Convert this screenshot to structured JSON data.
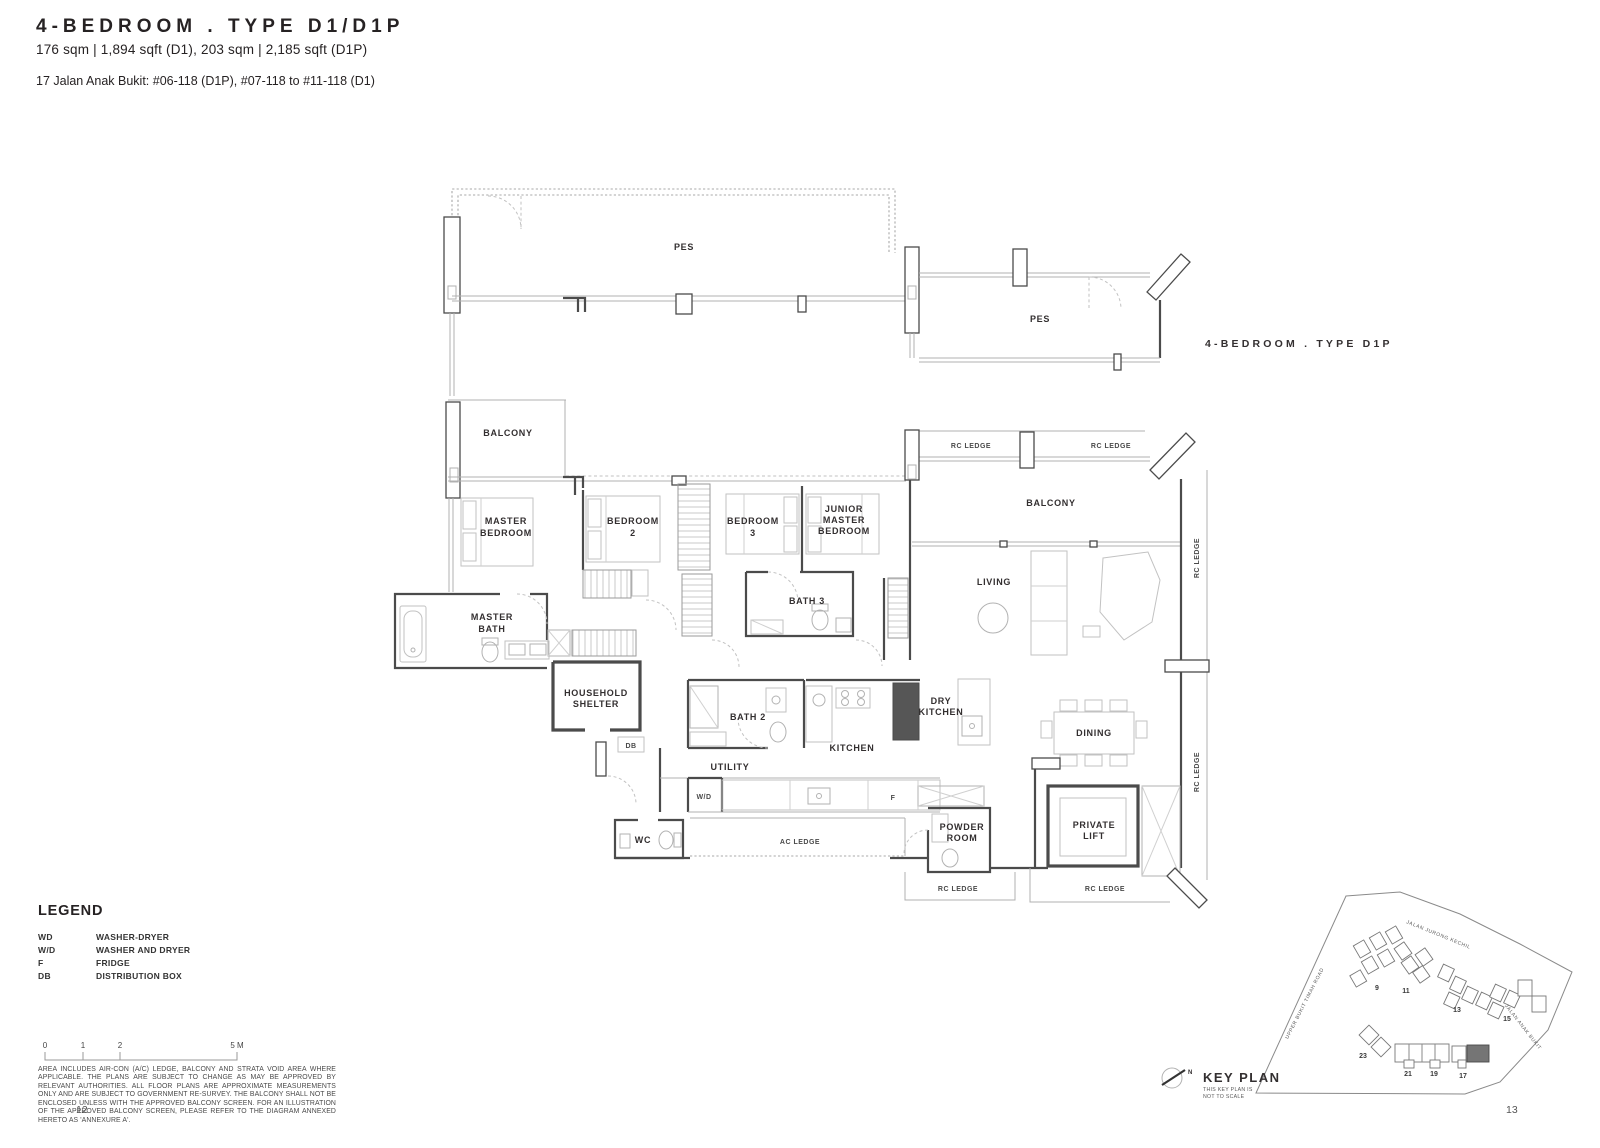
{
  "header": {
    "title": "4-BEDROOM . TYPE D1/D1P",
    "area_info": "176 sqm | 1,894 sqft (D1), 203 sqm | 2,185 sqft (D1P)",
    "address": "17 Jalan Anak Bukit: #06-118 (D1P), #07-118 to #11-118 (D1)"
  },
  "plan": {
    "variant_label": "4-BEDROOM . TYPE D1P",
    "rooms": {
      "pes1": "PES",
      "pes2": "PES",
      "balcony_left": "BALCONY",
      "balcony_right": "BALCONY",
      "master_bedroom": [
        "MASTER",
        "BEDROOM"
      ],
      "bedroom2": [
        "BEDROOM",
        "2"
      ],
      "bedroom3": [
        "BEDROOM",
        "3"
      ],
      "junior_master": [
        "JUNIOR",
        "MASTER",
        "BEDROOM"
      ],
      "master_bath": [
        "MASTER",
        "BATH"
      ],
      "bath3": "BATH 3",
      "bath2": "BATH 2",
      "household_shelter": [
        "HOUSEHOLD",
        "SHELTER"
      ],
      "kitchen": "KITCHEN",
      "dry_kitchen": [
        "DRY",
        "KITCHEN"
      ],
      "living": "LIVING",
      "dining": "DINING",
      "utility": "UTILITY",
      "wc": "WC",
      "powder_room": [
        "POWDER",
        "ROOM"
      ],
      "private_lift": [
        "PRIVATE",
        "LIFT"
      ]
    },
    "tags": {
      "db": "DB",
      "wd": "W/D",
      "f": "F",
      "ac_ledge": "AC LEDGE",
      "rc_ledge": "RC LEDGE"
    }
  },
  "legend": {
    "heading": "LEGEND",
    "rows": [
      {
        "abbr": "WD",
        "desc": "WASHER-DRYER"
      },
      {
        "abbr": "W/D",
        "desc": "WASHER AND DRYER"
      },
      {
        "abbr": "F",
        "desc": "FRIDGE"
      },
      {
        "abbr": "DB",
        "desc": "DISTRIBUTION BOX"
      }
    ]
  },
  "scale_bar": {
    "labels": [
      "0",
      "1",
      "2",
      "5 M"
    ]
  },
  "keyplan": {
    "title": "KEY PLAN",
    "note": [
      "THIS KEY PLAN IS",
      "NOT TO SCALE"
    ],
    "roads": [
      "JALAN JURONG KECHIL",
      "UPPER BUKIT TIMAH ROAD",
      "JALAN ANAK BUKIT"
    ],
    "blocks": [
      "9",
      "11",
      "13",
      "15",
      "23",
      "21",
      "19",
      "17"
    ],
    "compass": "N",
    "highlight_color": "#757575"
  },
  "footer": {
    "disclaimer": "AREA INCLUDES AIR-CON (A/C) LEDGE, BALCONY AND STRATA VOID AREA WHERE APPLICABLE. THE PLANS ARE SUBJECT TO CHANGE AS MAY BE APPROVED BY RELEVANT AUTHORITIES. ALL FLOOR PLANS ARE APPROXIMATE MEASUREMENTS ONLY AND ARE SUBJECT TO GOVERNMENT RE-SURVEY. THE BALCONY SHALL NOT BE ENCLOSED UNLESS WITH THE APPROVED BALCONY SCREEN. FOR AN ILLUSTRATION OF THE APPROVED BALCONY SCREEN, PLEASE REFER TO THE DIAGRAM ANNEXED HERETO AS 'ANNEXURE A'.",
    "page_left": "12",
    "page_right": "13"
  }
}
